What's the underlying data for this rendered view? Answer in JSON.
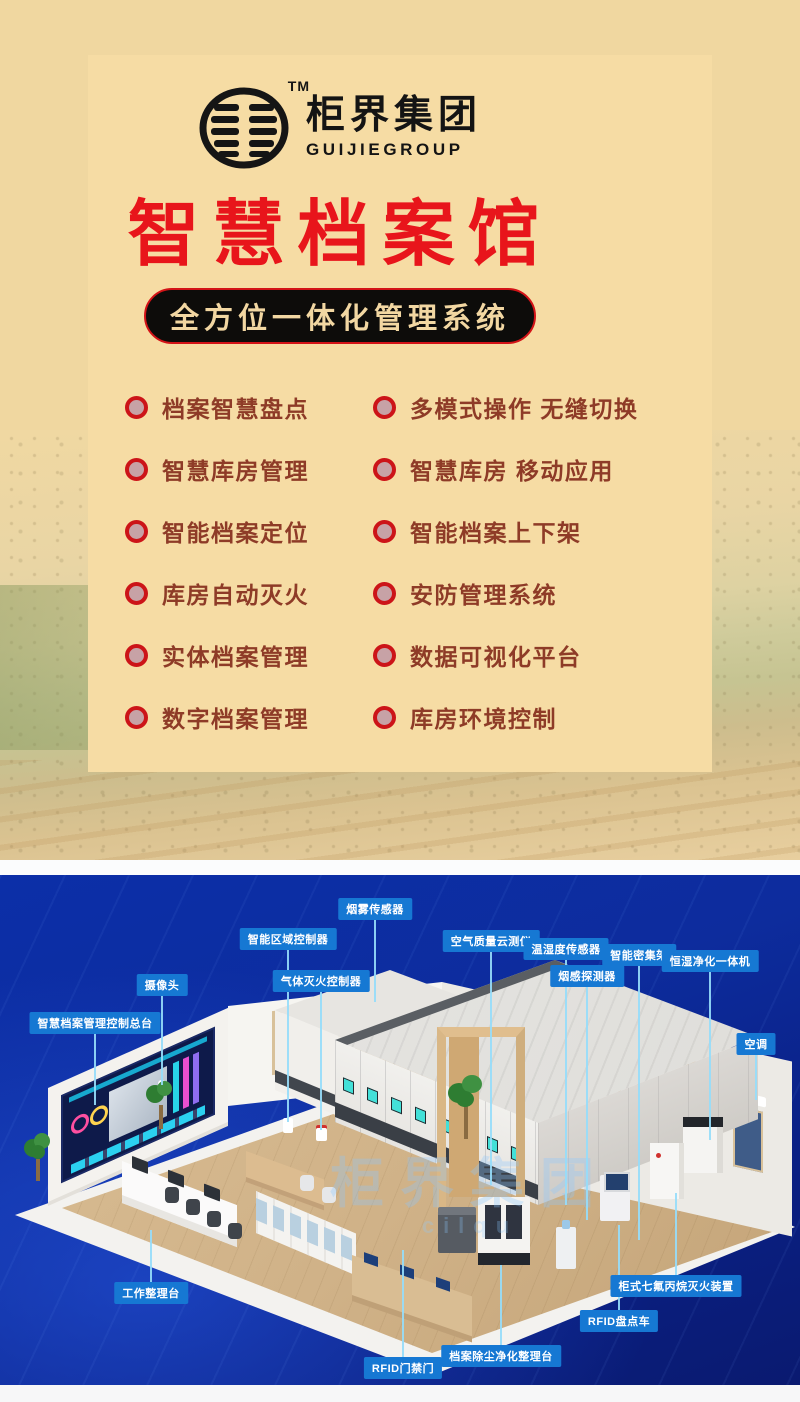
{
  "header": {
    "logo": {
      "brand_cn": "柜界集团",
      "brand_en": "GUIJIEGROUP",
      "tm": "TM"
    }
  },
  "hero": {
    "title": "智慧档案馆",
    "subtitle": "全方位一体化管理系统"
  },
  "features": {
    "items": [
      {
        "text": "档案智慧盘点"
      },
      {
        "text": "多模式操作 无缝切换"
      },
      {
        "text": "智慧库房管理"
      },
      {
        "text": "智慧库房 移动应用"
      },
      {
        "text": "智能档案定位"
      },
      {
        "text": "智能档案上下架"
      },
      {
        "text": "库房自动灭火"
      },
      {
        "text": "安防管理系统"
      },
      {
        "text": "实体档案管理"
      },
      {
        "text": "数据可视化平台"
      },
      {
        "text": "数字档案管理"
      },
      {
        "text": "库房环境控制"
      }
    ]
  },
  "scene": {
    "watermark": {
      "line1": "柜界集团",
      "line2": "cilqu"
    },
    "callouts": [
      {
        "text": "烟雾传感器"
      },
      {
        "text": "智能区域控制器"
      },
      {
        "text": "气体灭火控制器"
      },
      {
        "text": "摄像头"
      },
      {
        "text": "智慧档案管理控制总台"
      },
      {
        "text": "空气质量云测仪"
      },
      {
        "text": "温湿度传感器"
      },
      {
        "text": "烟感探测器"
      },
      {
        "text": "智能密集架"
      },
      {
        "text": "恒湿净化一体机"
      },
      {
        "text": "空调"
      },
      {
        "text": "工作整理台"
      },
      {
        "text": "RFID门禁门"
      },
      {
        "text": "档案除尘净化整理台"
      },
      {
        "text": "RFID盘点车"
      },
      {
        "text": "柜式七氟丙烷灭火装置"
      }
    ]
  },
  "colors": {
    "accent_red": "#e8151b",
    "panel_tan": "#f6dca4",
    "deep_blue": "#0c2b9c",
    "label_blue": "#1678d3",
    "text_brown": "#8e3b27"
  }
}
